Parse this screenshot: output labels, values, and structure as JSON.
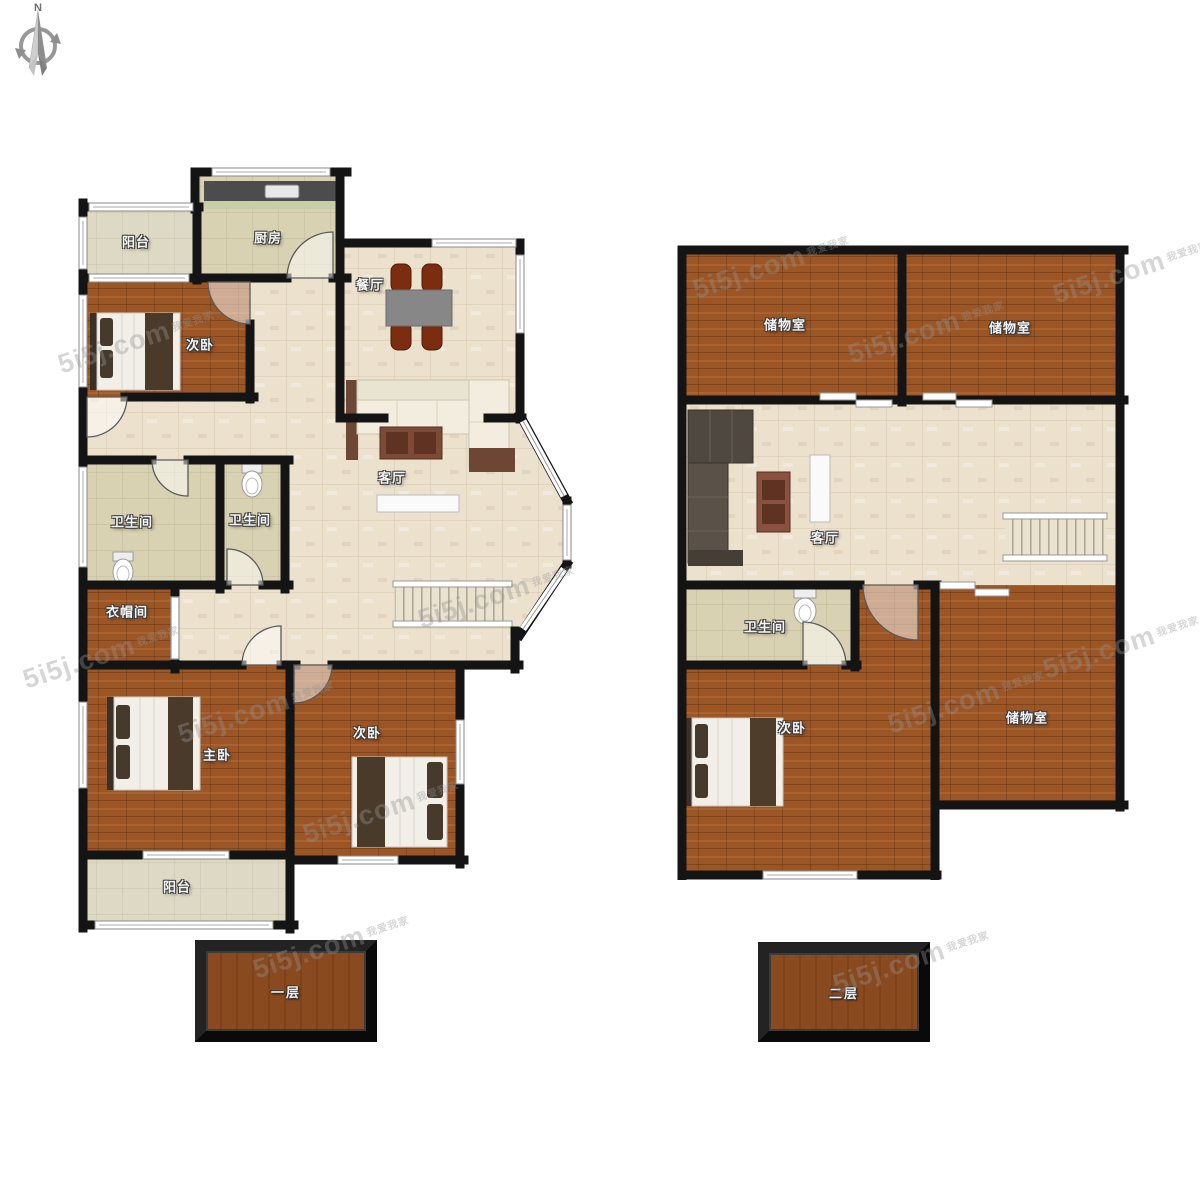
{
  "site": {
    "brand": "5i5j.com",
    "company": "我爱我家"
  },
  "compass": {
    "north_label": "N"
  },
  "floor1": {
    "name": "一层",
    "rooms": {
      "balcony_top": "阳台",
      "kitchen": "厨房",
      "bedroom_top": "次卧",
      "dining": "餐厅",
      "living": "客厅",
      "bath_left": "卫生间",
      "bath_right": "卫生间",
      "cloakroom": "衣帽间",
      "master_bedroom": "主卧",
      "bedroom_bottom": "次卧",
      "balcony_bottom": "阳台"
    }
  },
  "floor2": {
    "name": "二层",
    "rooms": {
      "storage_left": "储物室",
      "storage_right": "储物室",
      "living": "客厅",
      "bathroom": "卫生间",
      "bedroom": "次卧",
      "storage_bottom": "储物室"
    }
  },
  "colors": {
    "wall": "#141414",
    "wood_floor": "#9C5626",
    "tile_floor": "#ECE1CD",
    "khaki_floor": "#D8D2B3",
    "balcony_floor": "#DED9C4",
    "label_box": "#8A4A1F"
  }
}
